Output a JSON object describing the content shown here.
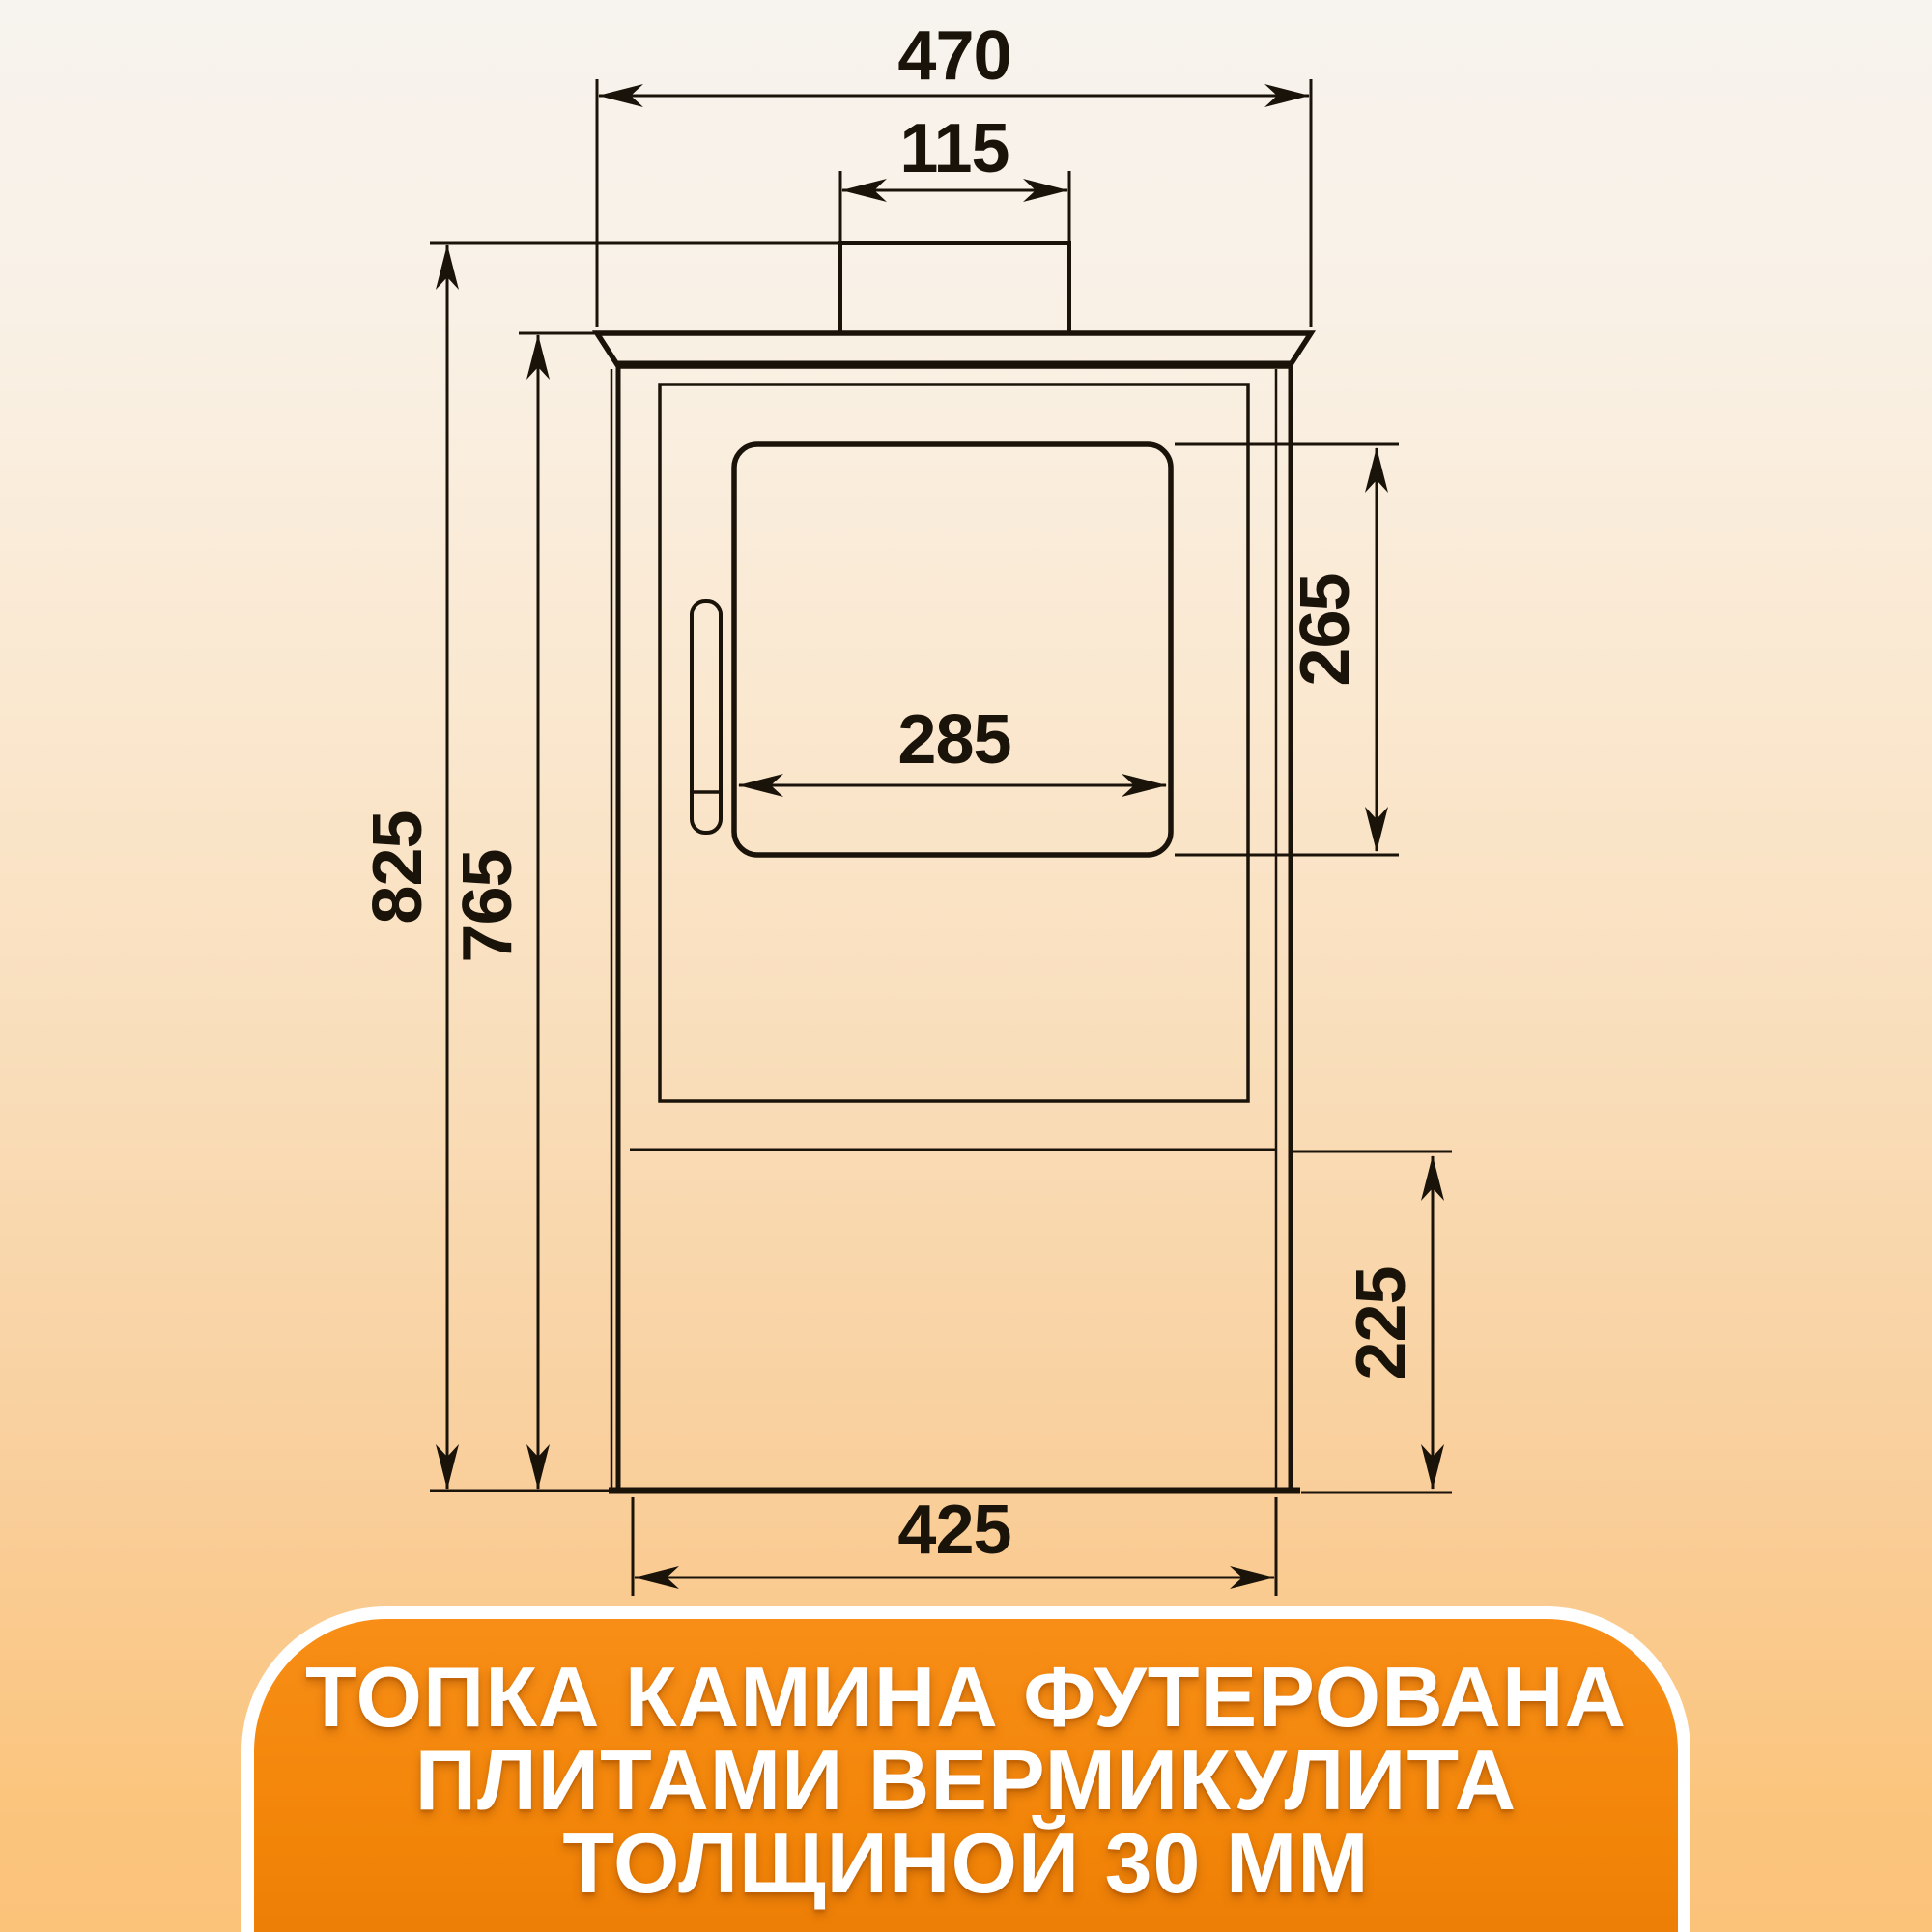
{
  "colors": {
    "ink": "#1a1309",
    "bg_top": "#f7f3ee",
    "bg_bottom": "#fbc57e",
    "accent_orange": "#f28508",
    "banner_border": "#ffffff",
    "banner_text": "#ffffff"
  },
  "drawing": {
    "type": "technical-front-view-of-wood-stove",
    "dimensions": {
      "top_plate_width": "470",
      "flue_pipe_width": "115",
      "overall_height": "825",
      "body_height": "765",
      "glass_width": "285",
      "glass_height": "265",
      "base_compartment_height": "225",
      "body_width": "425"
    }
  },
  "banner": {
    "lines": [
      "ТОПКА КАМИНА ФУТЕРОВАНА",
      "ПЛИТАМИ ВЕРМИКУЛИТА",
      "ТОЛЩИНОЙ 30 ММ"
    ]
  }
}
